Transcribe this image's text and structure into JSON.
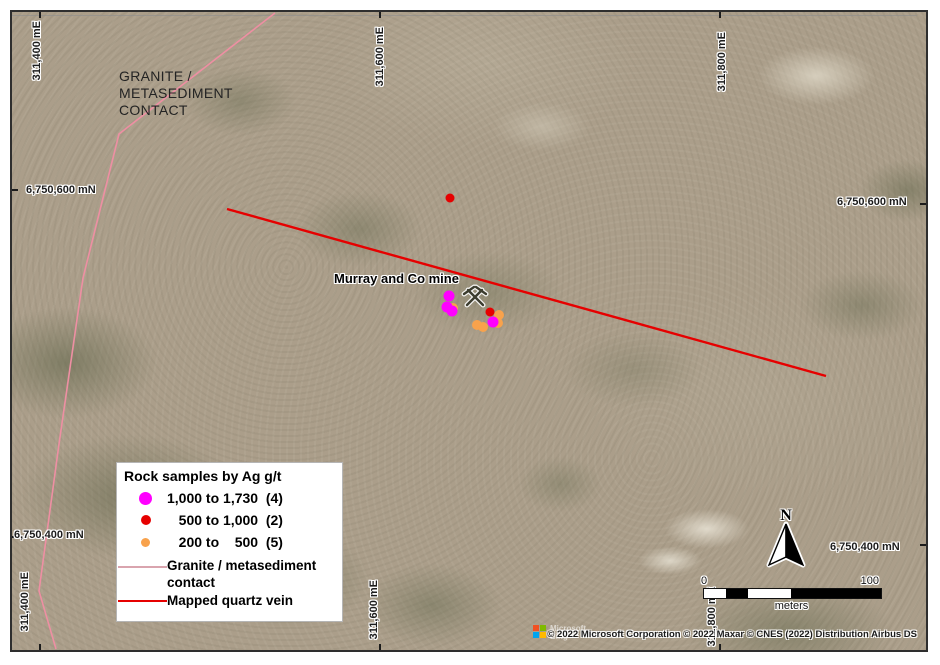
{
  "grid": {
    "eastings": [
      {
        "label": "311,400 mE"
      },
      {
        "label": "311,600 mE"
      },
      {
        "label": "311,800 mE"
      }
    ],
    "northings": [
      {
        "label": "6,750,600 mN"
      },
      {
        "label": "6,750,400 mN"
      }
    ]
  },
  "annotations": {
    "geology_label": {
      "line1": "GRANITE /",
      "line2": "METASEDIMENT",
      "line3": "CONTACT"
    },
    "mine": {
      "label": "Murray and Co mine"
    }
  },
  "features": {
    "granite_contact": {
      "name": "Granite / metasediment contact",
      "color": "#EE8FA3",
      "width": 1.6,
      "points": [
        [
          263,
          1
        ],
        [
          107,
          122
        ],
        [
          71,
          266
        ],
        [
          47,
          432
        ],
        [
          27,
          579
        ],
        [
          44,
          637
        ]
      ]
    },
    "quartz_vein": {
      "name": "Mapped quartz vein",
      "color": "#E60000",
      "width": 2.4,
      "points": [
        [
          215,
          197
        ],
        [
          814,
          364
        ]
      ]
    }
  },
  "samples": {
    "title": "Rock samples by Ag g/t",
    "groups": [
      {
        "name": "200 to 500 g/t",
        "count": 5,
        "color": "#F8A24C",
        "size": 10,
        "points": [
          [
            441,
            296
          ],
          [
            487,
            303
          ],
          [
            486,
            311
          ],
          [
            465,
            313
          ],
          [
            471,
            315
          ]
        ]
      },
      {
        "name": "500 to 1,000 g/t",
        "count": 2,
        "color": "#E60000",
        "size": 9,
        "points": [
          [
            438,
            186
          ],
          [
            478,
            300
          ]
        ]
      },
      {
        "name": "1,000 to 1,730 g/t",
        "count": 4,
        "color": "#FF00FF",
        "size": 11,
        "points": [
          [
            437,
            284
          ],
          [
            435,
            295
          ],
          [
            440,
            299
          ],
          [
            481,
            310
          ]
        ]
      }
    ]
  },
  "legend": {
    "title": "Rock samples by Ag g/t",
    "items": [
      {
        "label": "1,000 to 1,730  (4)",
        "color": "#FF00FF",
        "size": 13
      },
      {
        "label": "   500 to 1,000  (2)",
        "color": "#E60000",
        "size": 10
      },
      {
        "label": "   200 to    500  (5)",
        "color": "#F8A24C",
        "size": 9
      }
    ],
    "line_items": [
      {
        "label": "Granite / metasediment contact",
        "color": "#D9A4AE"
      },
      {
        "label": "Mapped quartz vein",
        "color": "#E60000"
      }
    ]
  },
  "north_arrow": {
    "label": "N"
  },
  "scale_bar": {
    "tick_start": "0",
    "tick_end": "100",
    "unit": "meters"
  },
  "attribution": {
    "copyright": "© 2022 Microsoft Corporation © 2022 Maxar © CNES (2022) Distribution Airbus DS",
    "logo_text": "Microsoft Bing"
  }
}
